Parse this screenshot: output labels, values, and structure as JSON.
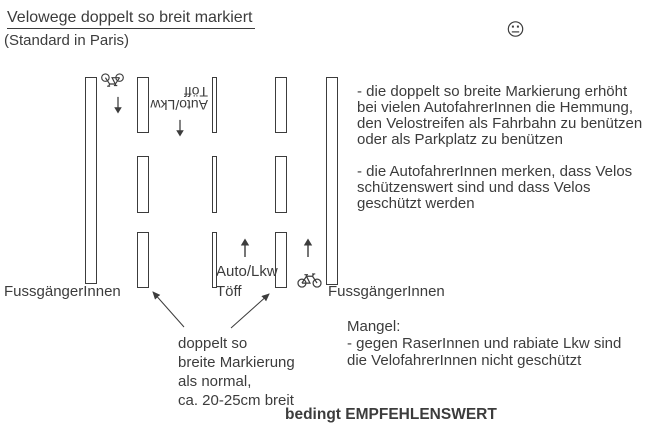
{
  "title": {
    "main": "Velowege doppelt so breit markiert",
    "sub": "(Standard in Paris)"
  },
  "street": {
    "pedestrians_left": "FussgängerInnen",
    "pedestrians_right": "FussgängerInnen",
    "car_lane_down": "Auto/Lkw\nTöff",
    "car_lane_up": "Auto/Lkw\nTöff",
    "marking_note": "doppelt so\nbreite Markierung\nals normal,\nca. 20-25cm breit"
  },
  "pros": {
    "p1": "- die doppelt so breite Markierung erhöht\nbei vielen AutofahrerInnen die Hemmung,\nden Velostreifen als Fahrbahn zu benützen\noder als Parkplatz zu benützen",
    "p2": "- die AutofahrerInnen merken, dass Velos\nschützenswert sind und dass Velos\ngeschützt werden"
  },
  "cons": {
    "heading": "Mangel:",
    "body": "- gegen RaserInnen und rabiate Lkw sind\ndie VelofahrerInnen nicht geschützt"
  },
  "verdict": "bedingt EMPFEHLENSWERT",
  "icons": {
    "smiley": "neutral-face-icon",
    "bicycle_down": "bicycle-icon-rotated-180",
    "bicycle_up": "bicycle-icon",
    "arrow_down": "down-arrow-icon",
    "arrow_up": "up-arrow-icon"
  },
  "colors": {
    "ink": "#3c3c3c",
    "background": "#ffffff"
  }
}
